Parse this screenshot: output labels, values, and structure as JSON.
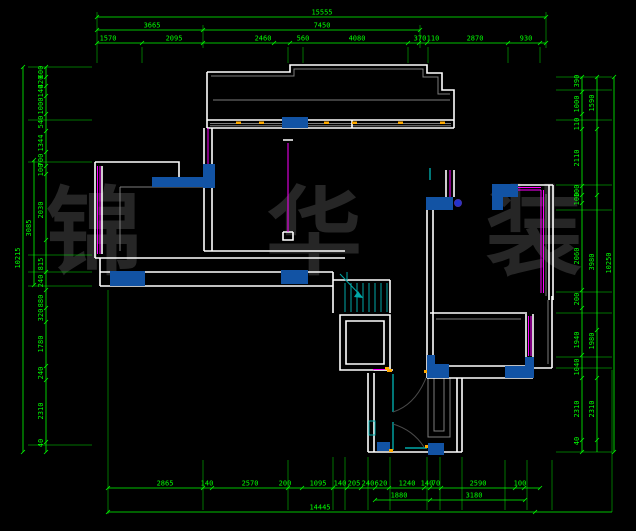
{
  "app": {
    "type": "cad-floor-plan"
  },
  "watermark": {
    "text": "锦华装饰",
    "display": "锦 华 装 饰",
    "color": "#262626"
  },
  "colors": {
    "background": "#000000",
    "dimension": "#00ff00",
    "wall": "#ffffff",
    "secondary": "#7d7d7d",
    "window": "#ff00ff",
    "fixture": "#00a8a8",
    "column_fill": "#1253a4",
    "hinge": "#ffaa00",
    "door_arc": "#4a4a4a"
  },
  "dimensions": {
    "chains": [
      {
        "id": "top-total",
        "dir": "h",
        "pos": 17,
        "from": 97,
        "to": 546,
        "ticks": [
          97,
          546
        ],
        "labels": [
          {
            "t": "15555",
            "at": 322
          }
        ]
      },
      {
        "id": "top-mid",
        "dir": "h",
        "pos": 30,
        "from": 97,
        "to": 420,
        "ticks": [
          97,
          203,
          420
        ],
        "labels": [
          {
            "t": "3665",
            "at": 152
          },
          {
            "t": "7450",
            "at": 322
          }
        ]
      },
      {
        "id": "top-seg",
        "dir": "h",
        "pos": 43,
        "from": 97,
        "to": 546,
        "ticks": [
          97,
          142,
          203,
          274,
          290,
          408,
          419,
          427,
          508,
          540,
          546
        ],
        "labels": [
          {
            "t": "1570",
            "at": 108
          },
          {
            "t": "2095",
            "at": 174
          },
          {
            "t": "2460",
            "at": 263
          },
          {
            "t": "560",
            "at": 303
          },
          {
            "t": "4080",
            "at": 357
          },
          {
            "t": "370",
            "at": 420
          },
          {
            "t": "110",
            "at": 433
          },
          {
            "t": "2870",
            "at": 475
          },
          {
            "t": "930",
            "at": 526
          }
        ]
      },
      {
        "id": "bottom-seg",
        "dir": "h",
        "pos": 488,
        "from": 108,
        "to": 540,
        "ticks": [
          108,
          203,
          212,
          288,
          302,
          333,
          347,
          361,
          375,
          389,
          424,
          430,
          441,
          515,
          524,
          540
        ],
        "labels": [
          {
            "t": "2865",
            "at": 165
          },
          {
            "t": "140",
            "at": 207
          },
          {
            "t": "2570",
            "at": 250
          },
          {
            "t": "200",
            "at": 285
          },
          {
            "t": "1095",
            "at": 318
          },
          {
            "t": "140",
            "at": 340
          },
          {
            "t": "205",
            "at": 354
          },
          {
            "t": "240",
            "at": 368
          },
          {
            "t": "620",
            "at": 381
          },
          {
            "t": "1240",
            "at": 407
          },
          {
            "t": "140",
            "at": 427
          },
          {
            "t": "70",
            "at": 436
          },
          {
            "t": "2590",
            "at": 478
          },
          {
            "t": "100",
            "at": 520
          }
        ]
      },
      {
        "id": "bottom-mid",
        "dir": "h",
        "pos": 500,
        "from": 375,
        "to": 525,
        "ticks": [
          375,
          430,
          525
        ],
        "labels": [
          {
            "t": "1880",
            "at": 399
          },
          {
            "t": "3180",
            "at": 474
          }
        ]
      },
      {
        "id": "bottom-total",
        "dir": "h",
        "pos": 512,
        "from": 108,
        "to": 612,
        "ticks": [
          108,
          535
        ],
        "labels": [
          {
            "t": "14445",
            "at": 320
          }
        ]
      },
      {
        "id": "left-total",
        "dir": "v",
        "pos": 23,
        "from": 67,
        "to": 452,
        "ticks": [
          67,
          452
        ],
        "labels": [
          {
            "t": "10215",
            "at": 258
          }
        ]
      },
      {
        "id": "left-mid",
        "dir": "v",
        "pos": 34,
        "from": 160,
        "to": 285,
        "ticks": [
          160,
          285
        ],
        "labels": [
          {
            "t": "3085",
            "at": 228
          }
        ]
      },
      {
        "id": "left-seg",
        "dir": "v",
        "pos": 46,
        "from": 67,
        "to": 452,
        "ticks": [
          67,
          77,
          86,
          96,
          114,
          131,
          152,
          166,
          174,
          240,
          272,
          290,
          308,
          322,
          366,
          380,
          442,
          452
        ],
        "labels": [
          {
            "t": "600",
            "at": 72
          },
          {
            "t": "420",
            "at": 82
          },
          {
            "t": "140",
            "at": 91
          },
          {
            "t": "1000",
            "at": 106
          },
          {
            "t": "540",
            "at": 122
          },
          {
            "t": "1344",
            "at": 143
          },
          {
            "t": "700",
            "at": 160
          },
          {
            "t": "100",
            "at": 170
          },
          {
            "t": "2030",
            "at": 210
          },
          {
            "t": "815",
            "at": 264
          },
          {
            "t": "240",
            "at": 281
          },
          {
            "t": "880",
            "at": 301
          },
          {
            "t": "320",
            "at": 315
          },
          {
            "t": "1780",
            "at": 344
          },
          {
            "t": "240",
            "at": 373
          },
          {
            "t": "2310",
            "at": 411
          },
          {
            "t": "40",
            "at": 443
          }
        ]
      },
      {
        "id": "right-seg",
        "dir": "v",
        "pos": 582,
        "from": 77,
        "to": 452,
        "ticks": [
          77,
          92,
          114,
          129,
          186,
          195,
          203,
          290,
          308,
          355,
          378,
          440,
          452
        ],
        "labels": [
          {
            "t": "390",
            "at": 81
          },
          {
            "t": "1000",
            "at": 104
          },
          {
            "t": "110",
            "at": 124
          },
          {
            "t": "2110",
            "at": 158
          },
          {
            "t": "100",
            "at": 191
          },
          {
            "t": "100",
            "at": 199
          },
          {
            "t": "2060",
            "at": 256
          },
          {
            "t": "200",
            "at": 299
          },
          {
            "t": "1940",
            "at": 340
          },
          {
            "t": "1040",
            "at": 367
          },
          {
            "t": "2310",
            "at": 409
          },
          {
            "t": "40",
            "at": 441
          }
        ]
      },
      {
        "id": "right-mid",
        "dir": "v",
        "pos": 597,
        "from": 77,
        "to": 452,
        "ticks": [
          77,
          129,
          195,
          330,
          378,
          440
        ],
        "labels": [
          {
            "t": "1590",
            "at": 103
          },
          {
            "t": "3980",
            "at": 262
          },
          {
            "t": "1980",
            "at": 341
          },
          {
            "t": "2310",
            "at": 409
          }
        ]
      },
      {
        "id": "right-total",
        "dir": "v",
        "pos": 614,
        "from": 77,
        "to": 452,
        "ticks": [
          77,
          452
        ],
        "labels": [
          {
            "t": "10250",
            "at": 263
          }
        ]
      }
    ]
  }
}
